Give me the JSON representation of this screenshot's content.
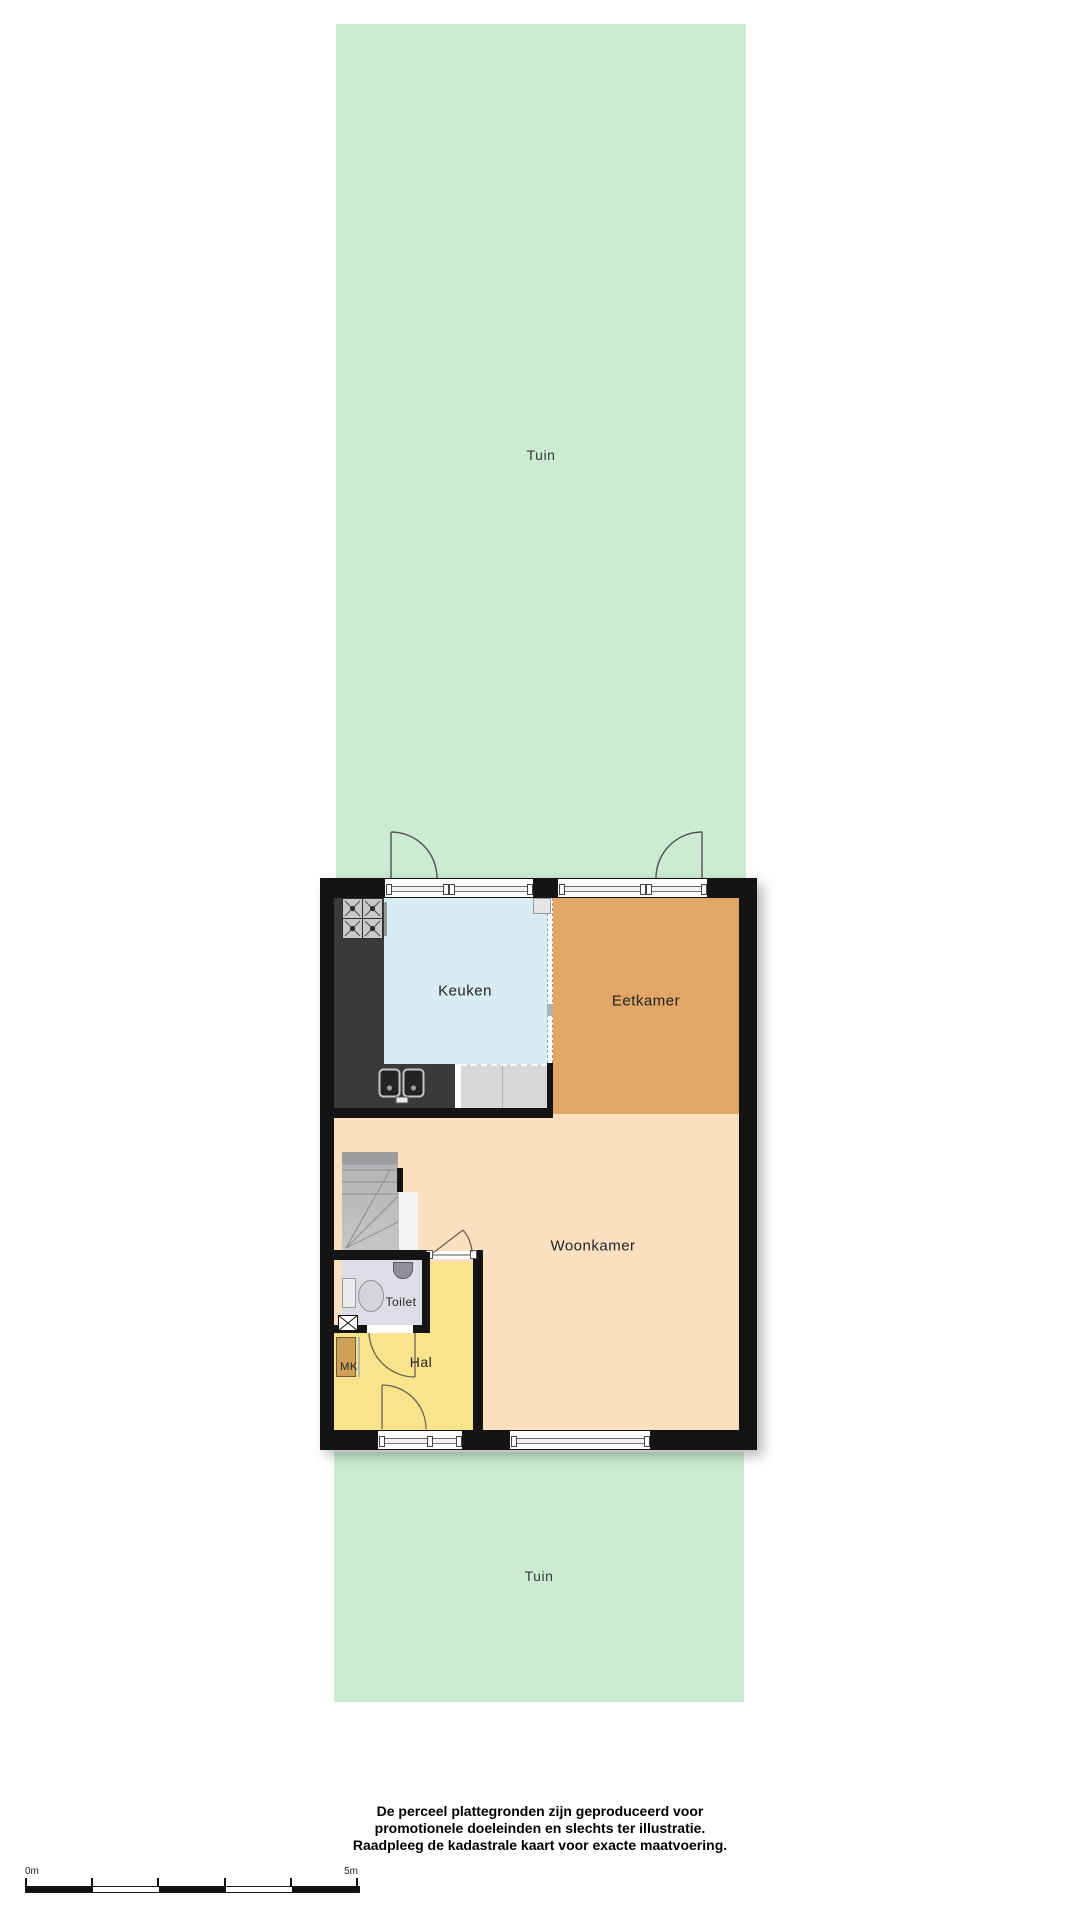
{
  "garden_top": {
    "label": "Tuin"
  },
  "garden_bottom": {
    "label": "Tuin"
  },
  "rooms": {
    "keuken": {
      "label": "Keuken",
      "color": "#d8ecf4"
    },
    "eetkamer": {
      "label": "Eetkamer",
      "color": "#e2a766"
    },
    "woonkamer": {
      "label": "Woonkamer",
      "color": "#fadfc1"
    },
    "hal": {
      "label": "Hal",
      "color": "#f9e48c"
    },
    "toilet": {
      "label": "Toilet",
      "color": "#dcdde6"
    },
    "mk": {
      "label": "MK",
      "color": "#cfa057"
    }
  },
  "colors": {
    "garden": "#cdebd2",
    "walls": "#141414",
    "counter": "#3a3a3a",
    "stairs": "#b4b4b7"
  },
  "footer": {
    "line1": "De perceel plattegronden zijn geproduceerd voor",
    "line2": "promotionele doeleinden en slechts ter illustratie.",
    "line3": "Raadpleeg de kadastrale kaart voor exacte maatvoering."
  },
  "scalebar": {
    "start": "0m",
    "end": "5m"
  }
}
